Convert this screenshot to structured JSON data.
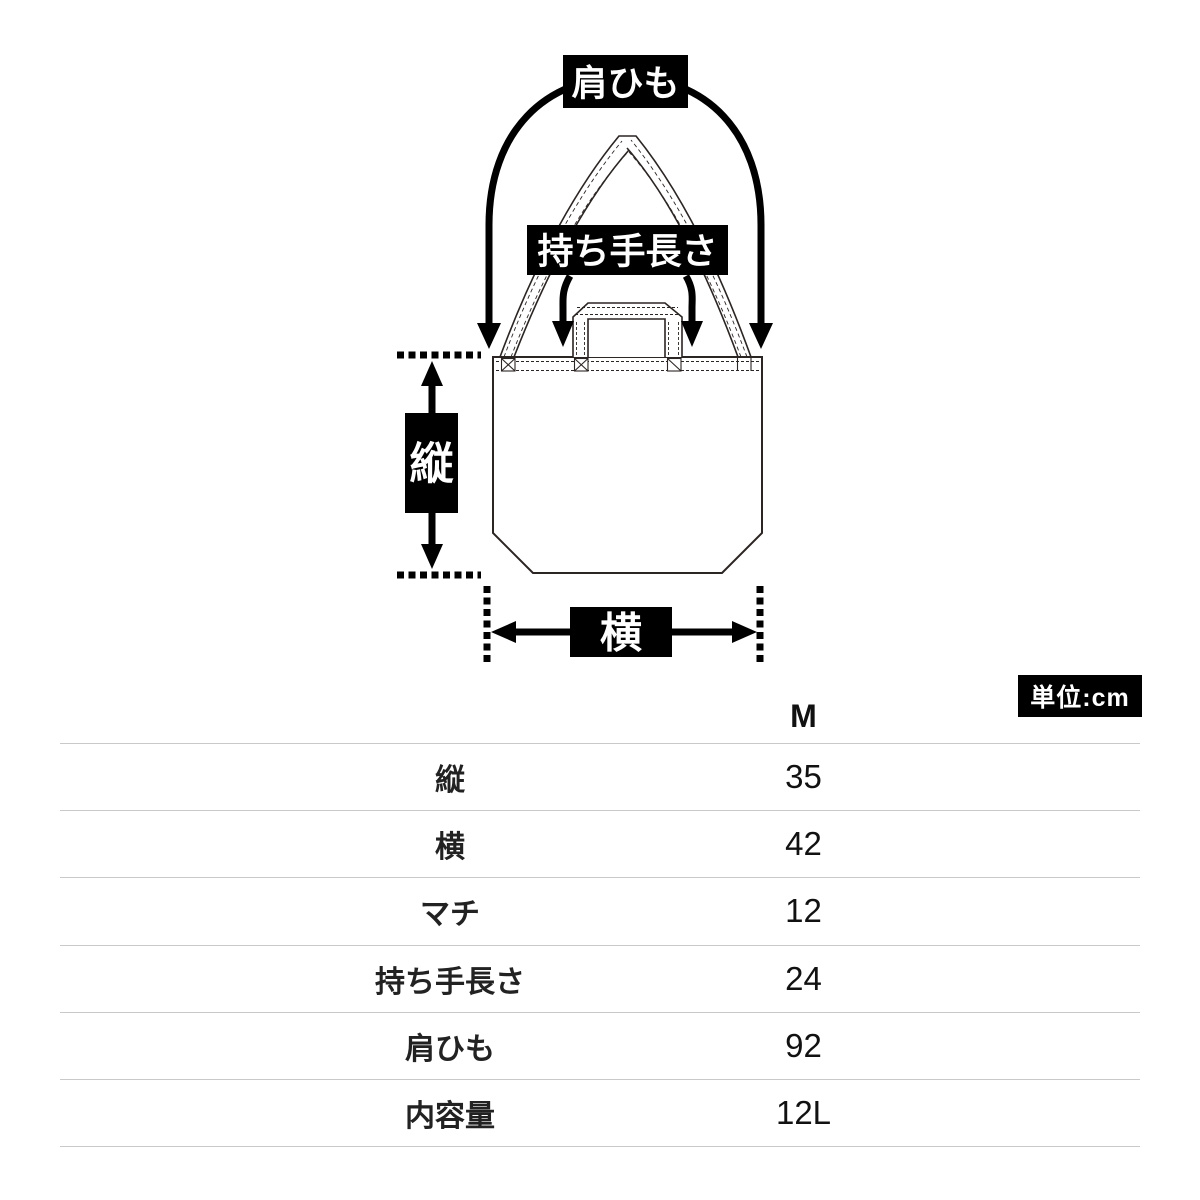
{
  "page": {
    "background": "#ffffff"
  },
  "colors": {
    "measure_ink": "#000000",
    "bag_outline": "#2b2523",
    "table_line": "#c9c9c9",
    "text": "#1a1a1a",
    "label_bg": "#000000",
    "label_fg": "#ffffff"
  },
  "diagram": {
    "shoulder_strap_label": "肩ひも",
    "handle_length_label": "持ち手長さ",
    "height_label": "縦",
    "width_label": "横"
  },
  "unit_badge": {
    "text": "単位:cm"
  },
  "size_table": {
    "size_column_header": "M",
    "rows": [
      {
        "label": "縦",
        "value": "35"
      },
      {
        "label": "横",
        "value": "42"
      },
      {
        "label": "マチ",
        "value": "12"
      },
      {
        "label": "持ち手長さ",
        "value": "24"
      },
      {
        "label": "肩ひも",
        "value": "92"
      },
      {
        "label": "内容量",
        "value": "12L"
      }
    ]
  }
}
